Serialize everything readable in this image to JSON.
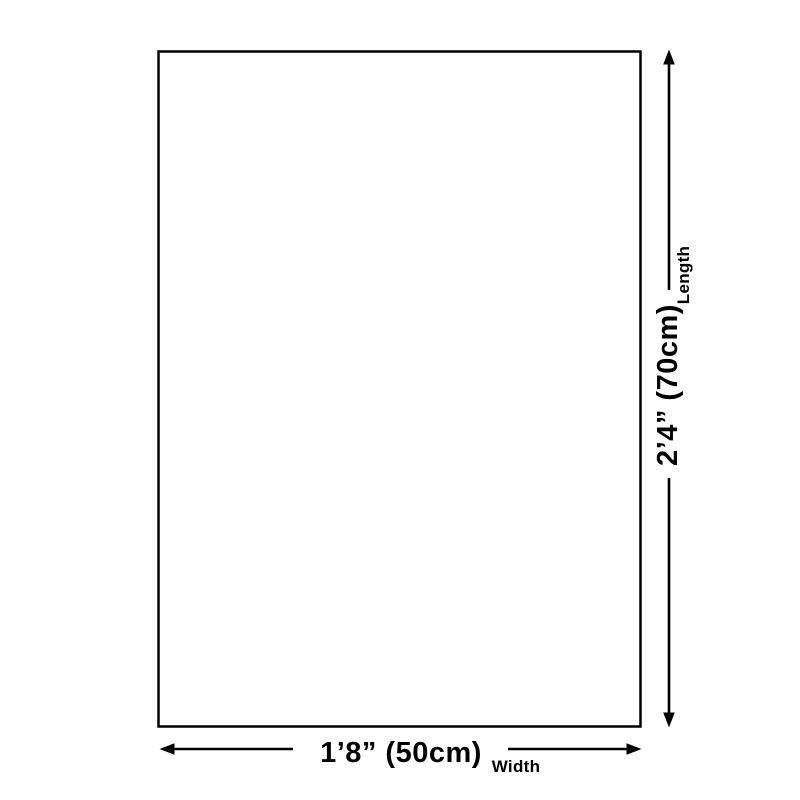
{
  "page": {
    "background_color": "#ffffff"
  },
  "diagram": {
    "line_color": "#000000",
    "text_color": "#000000",
    "length": {
      "value": "2’4” (70cm)",
      "label": "Length"
    },
    "width": {
      "value": "1’8” (50cm)",
      "label": "Width"
    }
  }
}
